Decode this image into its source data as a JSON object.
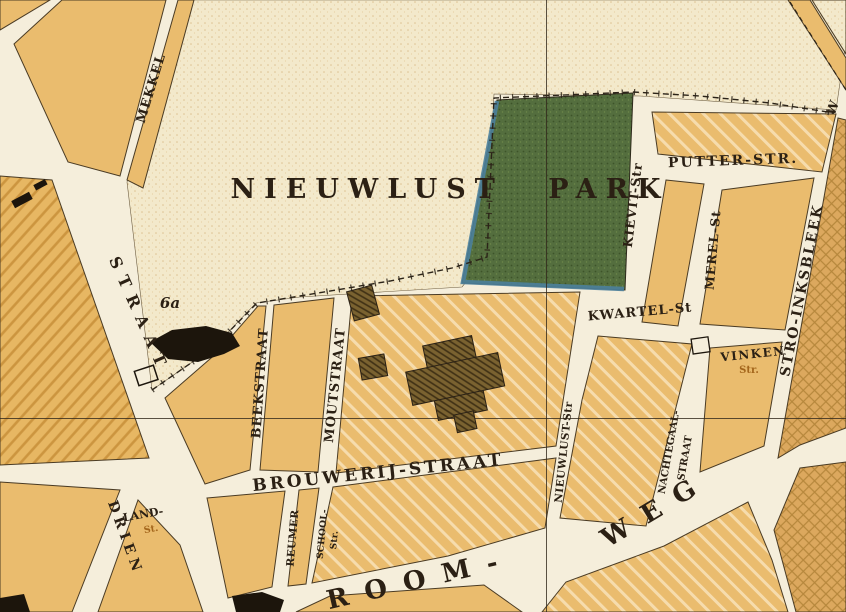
{
  "map": {
    "labels": {
      "park": "NIEUWLUST PARK",
      "putter": "PUTTER-STR.",
      "kievit": "KIEVIT-Str",
      "merel": "MEREL-St",
      "kwartel": "KWARTEL-St",
      "vinken": "VINKEN",
      "vinken_suffix": "Str.",
      "stroinksbleek": "STRO-INKSBLEEK",
      "nieuwlust_str": "NIEUWLUST-Str",
      "nachtegaal_line1": "NACHTEGAAL-",
      "nachtegaal_line2": "STRAAT",
      "brouwerij": "BROUWERIJ-STRAAT",
      "beekstraat": "BEEKSTRAAT",
      "moutstraat": "MOUTSTRAAT",
      "reumer": "REUMER",
      "school_line1": "SCHOOL-",
      "school_line2": "Str.",
      "land_line1": "LAND-",
      "land_line2": "St.",
      "drien": "DRIEN",
      "straat_left": "STRAAT",
      "mekkel": "MEKKEL",
      "room": "ROOM-",
      "weg": "WEG",
      "parcel_6a": "6a",
      "edge_cut_right": "W"
    },
    "colors": {
      "paper_street": "#f5eedb",
      "open_field": "#f3e9cb",
      "city_block": "#eabc6e",
      "park_green": "#546e3e",
      "water_blue": "#4b7f9b",
      "ink": "#2b2014",
      "secondary_label_brown": "#a4661c"
    }
  }
}
